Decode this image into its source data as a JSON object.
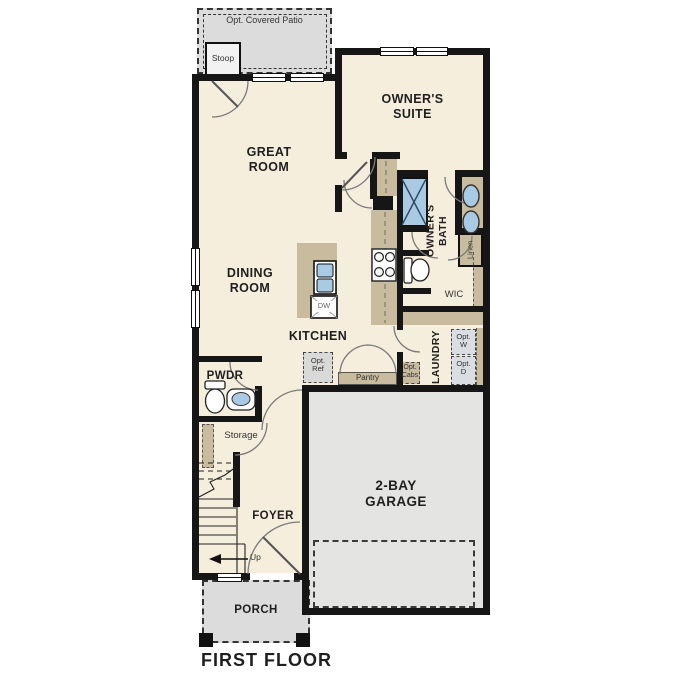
{
  "floor_label": "FIRST FLOOR",
  "rooms": {
    "patio": "Opt. Covered Patio",
    "stoop": "Stoop",
    "great_room": "GREAT\nROOM",
    "owners_suite": "OWNER'S\nSUITE",
    "owners_bath": "OWNER'S\nBATH",
    "linen": "Linen",
    "dining_room": "DINING\nROOM",
    "kitchen": "KITCHEN",
    "wic": "WIC",
    "laundry": "LAUNDRY",
    "pwdr": "PWDR",
    "storage": "Storage",
    "foyer": "FOYER",
    "garage": "2-BAY\nGARAGE",
    "porch": "PORCH"
  },
  "annotations": {
    "dishwasher": "DW",
    "opt_ref": "Opt.\nRef",
    "pantry": "Pantry",
    "opt_cabs": "Opt.\nCabs",
    "opt_washer": "Opt.\nW",
    "opt_dryer": "Opt.\nD",
    "up": "Up"
  },
  "colors": {
    "wall": "#161616",
    "interior_cream": "#f5eedd",
    "patio_gray": "#dcdcdc",
    "garage_gray": "#e4e4e2",
    "counter_tan": "#c9bb9e",
    "fixture_blue": "#a9cae3",
    "optional_appliance_gray": "#d8dee1",
    "optional_ref_gray": "#d9d9d7"
  }
}
